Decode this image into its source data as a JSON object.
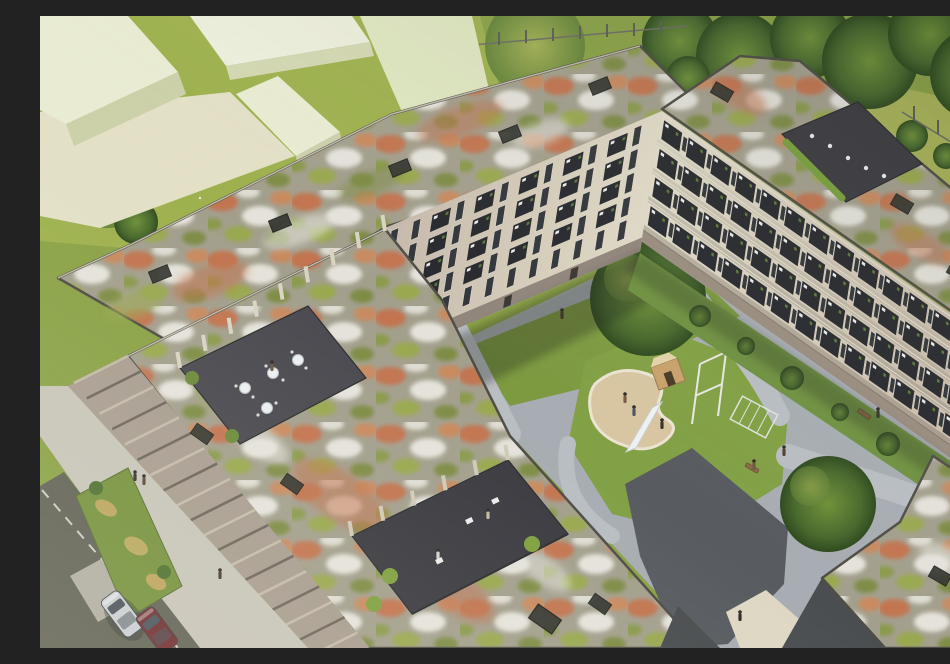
{
  "meta": {
    "title": "Aerial architectural rendering of a U-shaped residential complex with sedum green roofs and a courtyard playground",
    "media_type": "3D architectural visualization, bird's-eye view"
  },
  "palette": {
    "grass_base": "#8aa246",
    "lawn_light": "#9eb14e",
    "meadow": "#a9b357",
    "tree_dark": "#3c5c26",
    "tree_light": "#7fa23f",
    "sedum_base": "#a39f8d",
    "sedum_red": "#c2744f",
    "sedum_white": "#e4e2da",
    "sedum_green": "#9aa850",
    "roof_edge": "#4f4d45",
    "facade_light": "#ddd6c3",
    "facade_shaded": "#b9aaa1",
    "balcony": "#26282d",
    "window": "#32363a",
    "furniture_white": "#eceeec",
    "paving_light": "#a7adb2",
    "paving_dark": "#585c60",
    "sidewalk": "#c7c4b9",
    "asphalt": "#606156",
    "sand": "#d8c6a2",
    "massing_block": "#e9ecd2",
    "deck": "#3b3a40",
    "hedge_green": "#79a13c",
    "planter_green": "#75913d",
    "car_silver": "#c9ced3",
    "car_red": "#6e2b2f",
    "bench_wood": "#8a6a42"
  },
  "scene": {
    "surroundings": {
      "top_left": "lawn with white flowers and pale untextured massing blocks of neighboring buildings",
      "top_right": "dense tree row and wild-grass meadow behind a thin fence",
      "fence_count": 2
    },
    "neighboring_buildings": {
      "massing_blocks": 5,
      "style": "flat pale green-cream volumes without windows"
    },
    "main_complex": {
      "shape": "angular U of apartment wings around a shared courtyard",
      "facade_color": "cream plaster",
      "wings": [
        {
          "name": "north-wing",
          "floors": 5,
          "window_columns": 12,
          "balconies": "stacked dark balconies with white furniture and plants",
          "roof": "extensive sedum green roof"
        },
        {
          "name": "east-wing",
          "floors": 4,
          "window_columns": 13,
          "balconies": "terraced rows of dark balconies facing the courtyard",
          "roof": "sedum green roof with furnished corner roof terrace"
        },
        {
          "name": "southwest-wing",
          "floors": 4,
          "window_columns": 0,
          "balconies": "street facade articulated by vertical concrete fins",
          "roof": "large sedum green roof with two recessed roof terraces"
        }
      ]
    },
    "green_roofs": {
      "vegetation": [
        "red-orange sedum patches",
        "white flowering sedum",
        "light green sedum",
        "gravel areas"
      ],
      "skylights": 13,
      "terraces": [
        {
          "name": "cafe-terrace",
          "detail": "recessed deck with 4 round white tables and chairs"
        },
        {
          "name": "lounge-terrace",
          "detail": "dark deck with white loungers behind concrete fins"
        },
        {
          "name": "corner-roof-terrace",
          "detail": "furnished terrace with hedge planter on the east wing"
        }
      ]
    },
    "courtyard": {
      "ground": [
        "light gray paving loop",
        "lawn islands",
        "dark paved plaza"
      ],
      "playground": [
        "kidney-shaped sand pit",
        "wooden playhouse",
        "white slide",
        "climbing frame",
        "trellis screen"
      ],
      "trees": 2,
      "benches": 3,
      "garden_strip": "shrub border along the east wing facade"
    },
    "street": {
      "position": "bottom-left",
      "elements": [
        "light sidewalk",
        "asphalt road",
        "planting strip with dry grasses",
        "crosswalk band"
      ],
      "parked_cars": [
        {
          "color_name": "silver"
        },
        {
          "color_name": "dark red"
        }
      ]
    },
    "people_count": 14
  }
}
